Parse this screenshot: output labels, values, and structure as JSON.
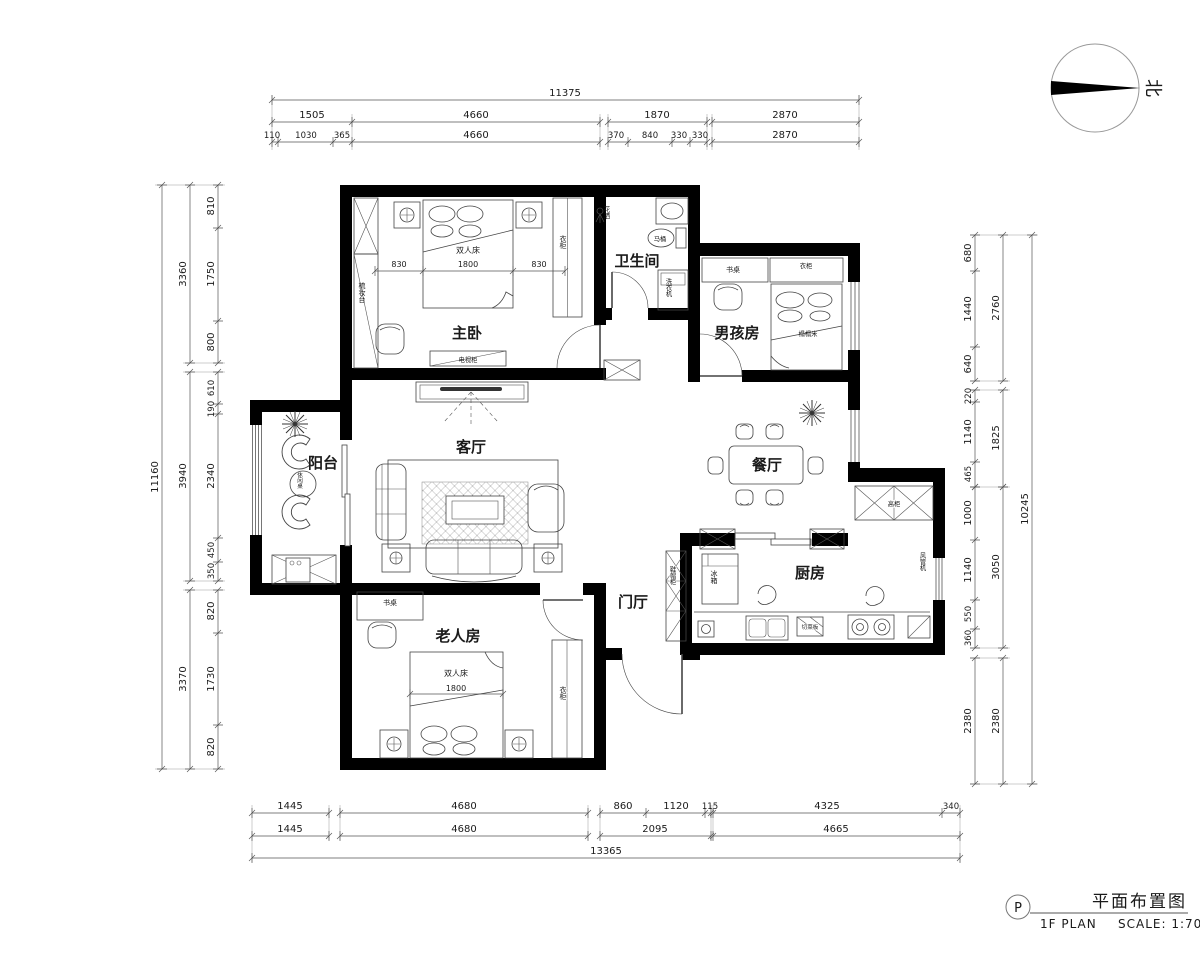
{
  "north": {
    "label": "北"
  },
  "title_block": {
    "mark": "P",
    "title": "平面布置图",
    "plan": "1F PLAN",
    "scale": "SCALE: 1:70"
  },
  "rooms": {
    "master": "主卧",
    "bath": "卫生间",
    "boy": "男孩房",
    "living": "客厅",
    "balcony": "阳台",
    "dining": "餐厅",
    "kitchen": "厨房",
    "foyer": "门厅",
    "elder": "老人房"
  },
  "labels": {
    "double_bed": "双人床",
    "bed_w": "1800",
    "bed_830l": "830",
    "bed_830r": "830",
    "elder_bed": "双人床",
    "elder_bed_w": "1800",
    "tv_cabinet": "电视柜",
    "dresser": "梳妆台",
    "wardrobe_master": "衣柜",
    "wardrobe_boy": "衣柜",
    "wardrobe_elder": "衣柜",
    "desk_boy": "书桌",
    "desk_elder": "书桌",
    "tatami": "榻榻米",
    "toilet": "马桶",
    "shower": "花洒",
    "washer": "洗衣机",
    "leisure_table": "休闲桌",
    "fridge": "冰箱",
    "tall_cabinet": "高柜",
    "cutting_board": "切菜板",
    "fan_coil": "风管机",
    "shoe_cabinet": "鞋帽柜"
  },
  "dims": {
    "top": {
      "total": "11375",
      "row2": [
        "1505",
        "4660",
        "1870",
        "2870"
      ],
      "row3": [
        "110",
        "1030",
        "365",
        "4660",
        "370",
        "840",
        "330",
        "330",
        "2870"
      ]
    },
    "bottom": {
      "row1": [
        "1445",
        "4680",
        "860",
        "1120",
        "115",
        "4325",
        "340"
      ],
      "row2": [
        "1445",
        "4680",
        "2095",
        "4665"
      ],
      "total": "13365"
    },
    "left": {
      "total": "11160",
      "mid": [
        "3360",
        "3940",
        "3370"
      ],
      "inner": [
        "810",
        "1750",
        "800",
        "610",
        "190",
        "2340",
        "450",
        "350",
        "820",
        "1730",
        "820"
      ]
    },
    "right": {
      "total": "10245",
      "mid": [
        "2760",
        "1825",
        "3050",
        "2380"
      ],
      "inner": [
        "680",
        "1440",
        "640",
        "220",
        "1140",
        "465",
        "1000",
        "1140",
        "550",
        "360",
        "2380"
      ]
    }
  }
}
